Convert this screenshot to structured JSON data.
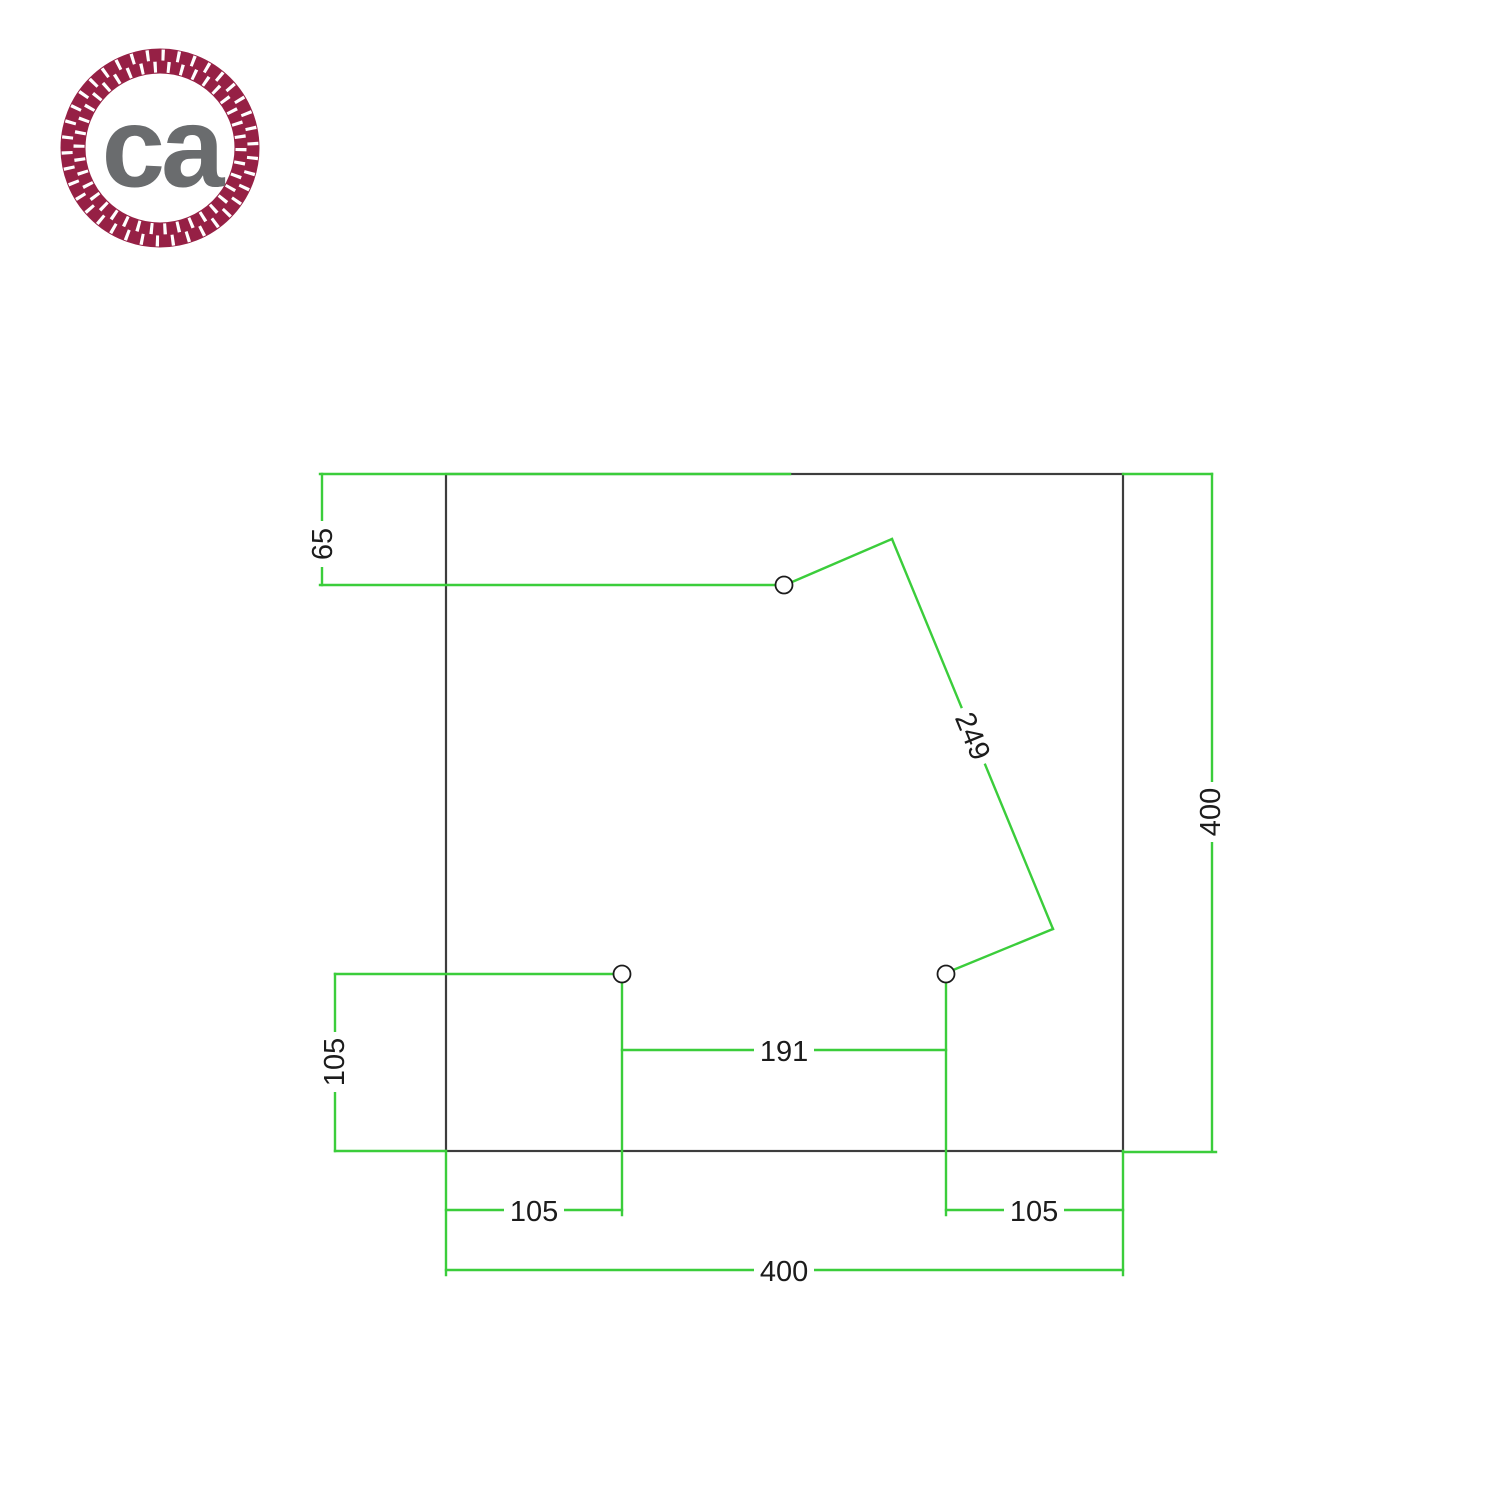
{
  "logo": {
    "text": "ca",
    "icon": "rope-ring-icon"
  },
  "colors": {
    "dim_green": "#3bcd3b",
    "outline": "#3d3d3d",
    "ink": "#1c1c1c",
    "rope": "#962045",
    "logo_gray": "#6a6c6e"
  },
  "drawing": {
    "type": "technical-dimension-drawing",
    "plate": {
      "shape": "square",
      "width_label": "400",
      "height_label": "400"
    },
    "holes_count": 3,
    "dimensions": [
      {
        "id": "hole1-top-offset",
        "value": "65",
        "orientation": "vertical"
      },
      {
        "id": "hole1-corner-diagonal",
        "value": "249",
        "orientation": "diagonal"
      },
      {
        "id": "hole2-bottom-offset",
        "value": "105",
        "orientation": "vertical"
      },
      {
        "id": "hole2-hole3-spacing",
        "value": "191",
        "orientation": "horizontal"
      },
      {
        "id": "hole2-left-offset",
        "value": "105",
        "orientation": "horizontal"
      },
      {
        "id": "hole3-right-offset",
        "value": "105",
        "orientation": "horizontal"
      },
      {
        "id": "plate-width",
        "value": "400",
        "orientation": "horizontal"
      },
      {
        "id": "plate-height",
        "value": "400",
        "orientation": "vertical"
      }
    ]
  }
}
